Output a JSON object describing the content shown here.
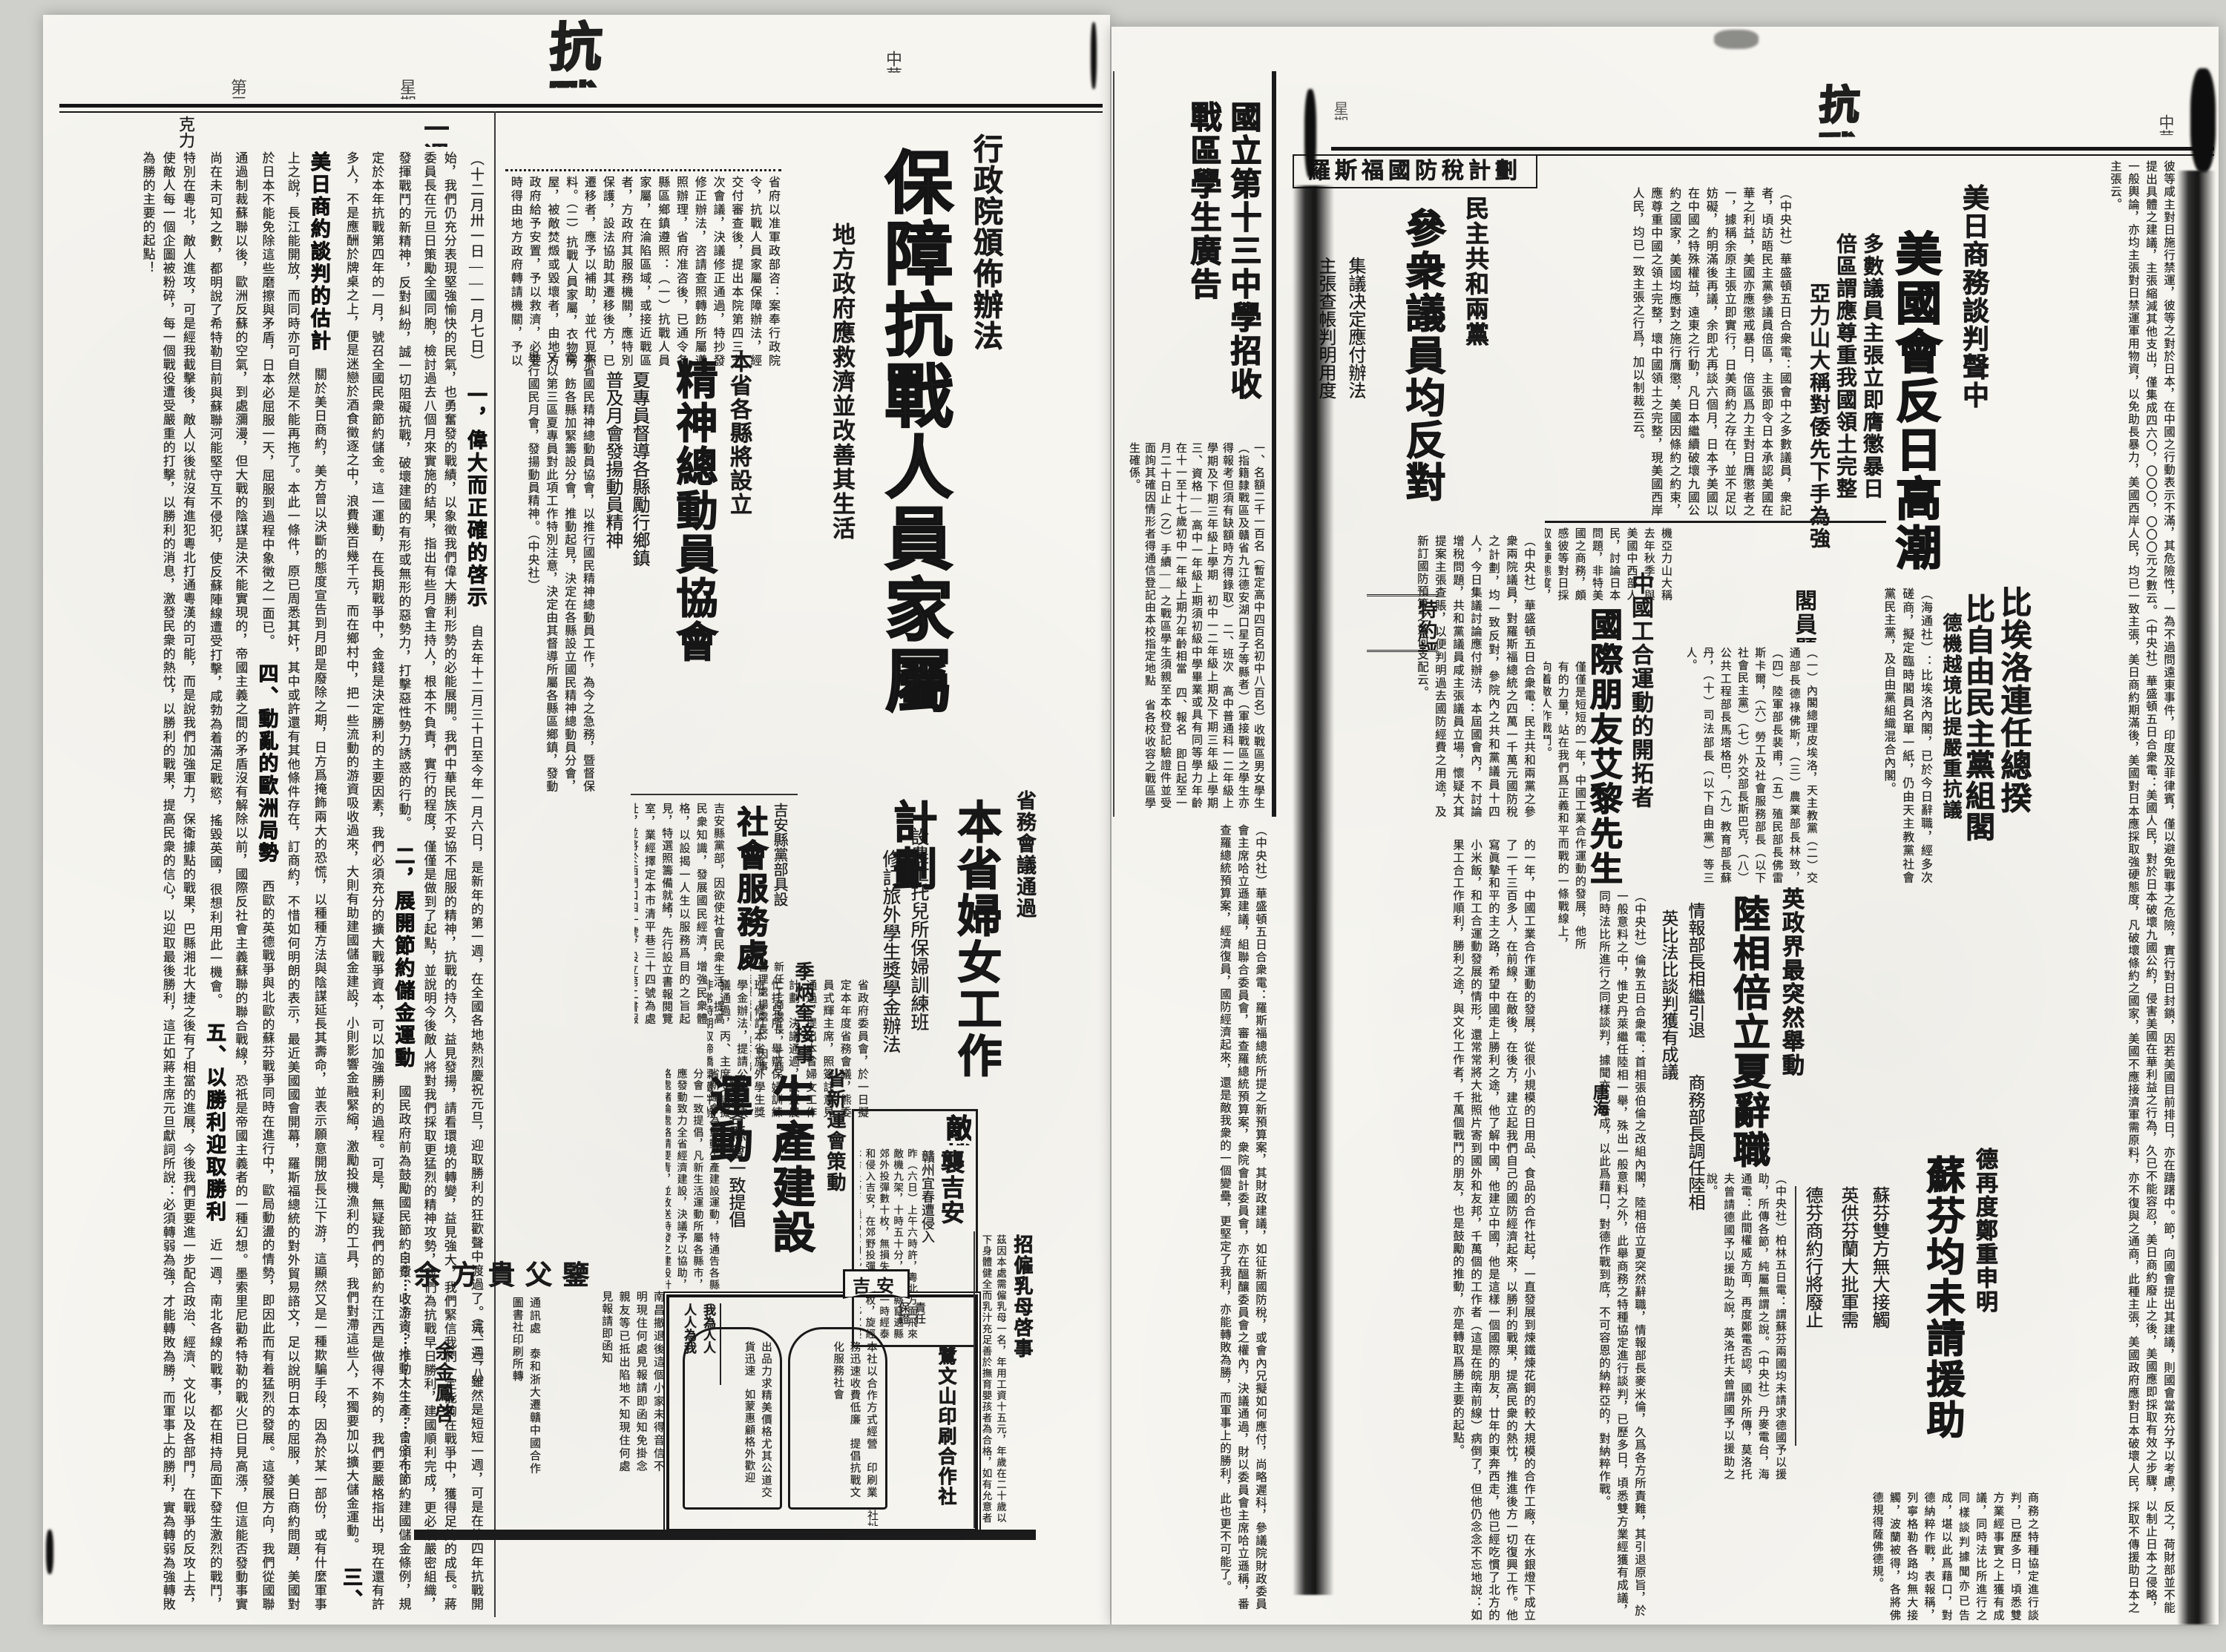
{
  "paper": {
    "masthead": "抗戰日報",
    "date": "中華民國二十九年一月七日",
    "weekday": "星期日",
    "edition": "第三版"
  },
  "lp": {
    "review": {
      "title": "一週時事述評",
      "byline": "克力",
      "range": "（十二月卅一日——一月七日）",
      "s1h": "一，偉大而正確的啓示",
      "s1": "自去年十二月三十日至今年一月六日，是新年的第一週，在全國各地熱烈慶祝元旦，迎取勝利的狂歡聲中渡過了。這一週，雖然是短短一週，可是在第四年抗戰開始，我們仍充分表現堅強愉快的民氣，也勇奮發的戰績，以象徵我們偉大勝利形勢的必能展開。我們中華民族不妥協不屈服的精神，抗戰的持久，益見發揚，請看環境的轉變，益見強大，我們緊信我們一定能夠在戰爭中，獲得足夠的成長。蔣委員長在元旦日策勵全國同胞，檢討過去八個月來實施的結果，指出有些月會主持人，根本不負責，實行的程度，僅僅是做到了起點，並說明今後敵人將對我們採取更猛烈的精神攻勢，我們為抗戰早日勝利，建國順利完成，更必須嚴密組織，發揮戰鬥的新精神，反對糾紛，誠一切阻礙抗戰，破壞建國的有形或無形的惡勢力，打擊惡性勢力誘惑的行動。",
      "s2h": "二，展開節約儲金運動",
      "s2": "國民政府前為鼓勵國民節約自費、收游資，推動大生產，曾頒布節約建國儲金條例，規定於本年抗戰第四年的一月，號召全國民衆節約儲金。這一運動，在長期戰爭中，金錢是決定勝利的主要因素，我們必須充分的擴大戰爭資本，可以加強勝利的過程。可是，無疑我們的節約在江西是做得不夠的，我們要嚴格指出，現在還有許多人，不是應酬於牌桌之上，便是迷戀於酒食徵逐之中，浪費幾百幾千元，而在鄉村中，把一些流動的游資吸收過來，大則有助建國儲金建設，小則影響金融緊縮，激勵投機漁利的工具，我們對滯這些人，不獨要加以擴大儲金運動。",
      "s3h": "三、美日商約談判的估計",
      "s3": "關於美日商約，美方曾以決斷的態度宣告到月即是廢除之期，日方爲掩飾兩大的恐慌，以種種方法與陰謀延長其壽命，並表示願意開放長江下游，這顯然又是一種欺騙手段，因為於某一部份，或有什麼軍事上之說，長江能開放，而同時亦可自然是不能再拖了。本此一條件，原已周悉其奸，其中或許還有其他條件存在，訂商約，不惜如何明朗的表示，最近美國國會開幕，羅斯福總統的對外貿易諮文，足以說明日本的屈服，美日商約問題，美國對於日本不能免除這些磨擦與矛盾，日本必屈服一天，屈服到過程中象徵之一面已。",
      "s4h": "四、動亂的歐洲局勢",
      "s4": "西歐的英德戰爭與北歐的蘇芬戰爭同時在進行中，歐局動盪的情勢，即因此而有着猛烈的發展。這發展方向，我們從國聯通過制裁蘇聯以後，歐洲反蘇的空氣，到處瀰漫，但大戰的陰謀是決不能實現的，帝國主義之間的矛盾沒有解除以前，國際反社會主義蘇聯的聯合戰線，恐祇是帝國主義者的一種幻想。墨索里尼勸希特勒的戰火已日見高漲，但這能否發動事實尚在未可知之數，都明說了希特勒目前與蘇聯河能堅守互不侵犯，使反蘇陣線遭受打擊，咸勃為着滿足戰慾，搖毀英國，很想利用此一機會。",
      "s5h": "五、以勝利迎取勝利",
      "s5": "近一週，南北各線的戰事，都在相持局面下發生激烈的戰鬥，特別在粵北，敵人進攻，可是經我截擊後，敵人以後就沒有進犯粵北打通粵漢的可能，而是說我們加強軍力，保衛據點的戰果，巴縣湘北大捷之後有了相當的進展，今後我們更要進一步配合政治、經濟、文化以及各部門，在戰爭的反攻上去，使敵人每一個企圖被粉碎，每一個戰役遭受嚴重的打擊，以勝利的消息，激發民衆的熱忱，以勝利的戰果，提高民衆的信心，以迎取最後勝利，這正如蔣主席元旦獻詞所說：必須轉弱為強，才能轉敗為勝，而軍事上的勝利，實為轉弱為強轉敗為勝的主要的起點！"
    },
    "fp": {
      "kicker": "行政院頒佈辦法",
      "headline": "保障抗戰人員家屬",
      "subhead": "地方政府應救濟並改善其生活",
      "body": "省府以准軍政部咨：案奉行政院令，抗戰人員家屬保障辦法，經交付審查後，提出本院第四三七次會議，決議修正通過，特抄發修正辦法，咨請查照轉飭所屬遵照辦理，省府准咨後，已通令各縣區鄉鎮遵照：（一）抗戰人員家屬，在淪陷區域，或接近戰區者，方政府其服務機關，應特別保護，設法協助其遷移後方，已遷移者，應予以補助，並代覓照料。（二）抗戰人員家屬，衣物房屋，被敵焚燬或毀壞者，由地方政府給予安置，予以救濟，必要時得由地方政府轉請機關，予以撫卹。（聯合社）"
    },
    "spirit": {
      "kicker": "本省各縣將設立",
      "headline": "精神總動員協會",
      "sub1": "夏專員督導各縣勵行鄉鎮",
      "sub2": "普及月會發揚動員精神",
      "body": "本省國民精神總動員協會，以推行國民精神總動員工作，為今之急務，暨督保電，飭各縣加緊籌設分會，推動起見，決定在各縣設立國民精神總動員分會，又以第三區夏專員對此項工作特別注意，決定由其督導所屬各縣區鄉鎮，發動舉行國民月會，發揚動員精神。（中央社）"
    },
    "social": {
      "kicker": "吉安縣黨部具設",
      "headline": "社會服務處",
      "body": "吉安縣黨部，因欲使社會民衆生活，提高民衆知識，發展國民經濟，增強民衆體格，以設揭一人生以服務爲目的之旨起見，特選照籌備就緒，先行設立書報閱覽室，業經擇定本市清平巷三十四號為處址，並將於西門口四十號，設立第二書報閱覽室云。（中央社）"
    },
    "women": {
      "kicker": "省務會議通過",
      "headline": "本省婦女工作計劃",
      "sub1": "設農忙托兒所保婦訓練班",
      "sub2": "修訂旅外學生獎學金辦法",
      "body": "省政府委員會，於一日擬定本年度省務會議，熊委員式輝主席，照簽註意見通過，提出本省婦女工作計劃，決議通過，設置農忙托兒所，舉辦保婦訓練班，修訂本省旅外學生獎學金辦法，提請公決，決議通過，丙、主席交議擬非常時期取締橋樑鐵件辦法，建設廳先後簽註核施行等情，經秘書處簽註意見通過。"
    },
    "prod": {
      "kicker": "省新運會策動",
      "headline": "生產建設運動",
      "subhead": "通告各縣會一致提倡",
      "body": "省新運會為策動生產建設運動，特通告各縣分會一致提倡，凡新生活運動所屬各縣市，應發動致力全省經濟建設，決議予以協助，路處緒論處絡請要青，並致送特發之建設計劃一千三百份，遍發滿閭巷調省，遵辦即均鵬翔代理。（中央社）"
    },
    "ji": {
      "headline": "季炳奎接事",
      "body": "新任工商處長，工商管理處楊處長，因事繁無暇兼顧，經省務會議決定，派季炳奎代理，茲悉季處長，已到處視事。"
    },
    "raid": {
      "headline": "敵機九架",
      "headline2": "襲吉安",
      "subhead": "贛州宜春遭侵入",
      "body": "昨（六日）上午六時許，粵北方面飛來敵機九架，十時五十分，由贛縣竄遶縣郊外投彈數十枚，無損失，十一時經泰和侵入吉安，在郊野投彈廿餘枚，旋經本市上空，飛高安向北竄去，此次襲擊，本市曾發緊報，寬過行劫空防深。（中央社）"
    },
    "ads": {
      "nurse": {
        "title": "招僱乳母啓事",
        "body": "茲因本處需僱乳母一名，年用工資十五元，年歲在二十歲以下身體健全而乳汁充足善於撫育嬰孩者為合格，如有允意者請至市下文山路九三號本報館接洽可也。"
      },
      "coop": {
        "banner": "吉安",
        "slogan1": "人人為我",
        "slogan2": "我為人人",
        "label1": "責任",
        "label2": "保證",
        "arc1": "本社以合作方式經營　印刷業務迅速收費低廉　提倡抗戰文化服務社會",
        "arc2": "出品力求精美價格尤其公道交貨迅速　如蒙惠顧格外歡迎",
        "name": "鷺文山印刷合作社",
        "addr": "社址蘇統領八號"
      },
      "fam": {
        "title": "余方貴父鑒",
        "body": "南昌撤退後這個小家未得音信不明現住何處見報請即函知免掛念　親友等已抵出陷地不知現住何處見報請即函知",
        "contact": "通訊處　泰和浙大遷贛中國合作圖書社印刷所轉",
        "code": "（元、二一八）",
        "signer": "余金鳳啓"
      }
    }
  },
  "mid": {
    "school": {
      "title1": "國立第十三中學招收",
      "title2": "戰區學生廣告",
      "body": "一、名額二千一百名（暫定高中四百名初中八百名）收戰區男女學生（指籍隸戰區及贛省九江德安湖口星子等縣者）（軍接戰區之學生亦得報考但須有缺額時方得錄取）　二、班次　高中普通科一二年級上學期及下期三年級上學期　初中一二年級上期及下期三年級上學期　三、資格——高中一年級上期須初級中學畢業或具有同等學力年齡在十一至十七歲初中一年級上期力年齡相當　四、報名　即日起至一月二十日止（乙）手續——之戰區學生須親至本校登記驗證件並受面詢其確因情形者得通信登記由本校指定地點　省各校收容之戰區學生確係。"
    }
  },
  "rp": {
    "us": {
      "kicker": "美日商務談判聲中",
      "headline": "美國會反日高潮",
      "sub1": "多數議員主張立即膺懲暴日",
      "sub2": "倍區謂應尊重我國領土完整",
      "sub3": "亞力山大稱對倭先下手為強",
      "body": "（中央社）華盛頓五日合衆電：國會中之多數議員，衆記者，頃訪晤民主黨參議員倍區，主張即令日本承認美國在華之利益，美國亦應懲戒暴日，倍區爲力主對日膺懲者之一，據稱余原主張立即實行，日美商約之存在，並不足以妨礙，約明滿後再議，余即尤再談六個月，日本予美國以在中國之特殊權益，遠東之行動，凡日本繼續破壞九國公約之國家，美國均應對之施行膺懲，美國因條約之約束，應尊重中國之領土完整，壞中國領土之完整，現美國西岸人民，均已一致主張之行爲，加以制裁云云。",
      "body2": "機亞力山大稱去年秋季，與美國中西部人民，討論日本問題，非特美國之商務，頗感彼等對日採取強硬態度，羅斯福之態度，對中國、澳大利亞、紐西蘭，前南途可循，則無異自角，發生危險，但爲將來計仍不願中國，得寸進尺，則將來日本，採取強硬態度，得無量六。",
      "strip": "彼等咸主對日施行禁運，彼等之對於日本，在中國之行動表示不滿，其危險性，一為不過問遠東事件，印度及菲律賓，僅以避免戰事之危險，實行對日封鎖，因若美國目前排日，亦在躊躇中。節，向國會提出其建議，則國會當充分予以考慮，反之，荷財部並不能提出具體之建議，主張縮減其他支出，僅集成四六〇，〇〇〇，〇〇〇元之數云。（中央社）華盛頓五日合衆電：美國人民，對於日本破壞九國公約，侵害美國在華利益之行為，久已不能容忍，美日商約廢止之後，美國應即採取有效之步驟，以制止日本之侵略，一般輿論，亦均主張對日禁運軍用物資，以免助長暴力，美國西岸人民，均已一致主張，美日商約期滿後，美國對日本應採取強硬態度，凡破壞條約之國家，美國不應接濟軍需原料，亦不復與之通商，此種主張，美國政府應對日本破壞人民，採取不傳援助日本之主張云。"
    },
    "tax": {
      "box": "羅斯福國防稅計劃",
      "kicker": "民主共和兩黨",
      "headline": "參衆議員均反對",
      "sub1": "集議决定應付辦法",
      "sub2": "主張查帳判明用度",
      "body": "（中央社）華盛頓五日合衆電：民主共和兩黨之參衆兩院議員，對羅斯福總統之四萬一千萬元國防稅之計劃，均一致反對，參院內之共和黨議員十四人，今日集議討論應付辦法，本屆國會內，不討論增稅問題，共和黨議員咸主張議員立場，懷疑大其提案主張查賬，以便判明過去國防經費之用途，及新訂國防預算之如何支配云。",
      "body2": "（中央社）華盛頓五日合衆電：羅斯福總統所提之新預算案，其財政建議，如征新國防稅，或會內兄擬如何應付，尚略遲科，參議院財政委員會主席哈立遜建議，組聯合委員會，審查羅總統預算案，衆院會計委員會，亦在醞釀委員會之權內，決議通過，財以委員會主席哈立遜稱，番查羅總統預算案，經濟復員，國防經濟起來，還是敵我衆的一個變壘，更堅定了我利，亦能轉敗為勝，而軍事上的勝利，此也更不可能了。"
    },
    "bel": {
      "h1": "比埃洛連任總揆",
      "h2": "比自由民主黨組閣",
      "sub": "德機越境比提嚴重抗議",
      "roster_title": "閣員題名",
      "roster": "（一）內閣總理皮埃洛，天主教黨（二）交通部長德祿佛斯，（三）農業部長林致，（四）陸軍部長裴甫，（五）殖民部長佛雷斯卡爾，（六）勞工及社會服務部長（以下社會民主黨）（七）外交部長斯巴克，（八）公共工程部長馬塔格巴，（九）教育部長蘇丹，（十）司法部長（以下自由黨）等三人。",
      "body": "（海通社）：比埃洛內閣，已於今日辭職，經多次磋商，擬定臨時閣員名單一紙，仍由天主教黨社會黨民主黨，及自由黨組織混合內閣。"
    },
    "uk": {
      "kicker": "英政界最突然舉動",
      "headline": "陸相倍立夏辭職",
      "sub1": "情報部長相繼引退",
      "sub2": "商務部長調任陸相",
      "sub3": "英比法比談判獲有成議",
      "body": "（中央社）倫敦五日合衆電：首相張伯倫之改組內閣，陸相倍立夏突然辭職，情報部長麥米倫，久爲各方所責難，其引退原旨，於一般意料之中，惟史丹萊繼任陸相一舉，殊出一般意料之外，此舉商務之特種協定進行談判，已歷多日，頃悉雙方業經獲有成議，同時法比所進行之同樣談判，據聞亦已告成，以此爲藉口，對德作戰到底，不可容恩的納粹亞的，對納粹作戰。"
    },
    "ger": {
      "kicker": "德再度鄭重申明",
      "headline": "蘇芬均未請援助",
      "sub1": "蘇芬雙方無大接觸",
      "sub2": "英供芬蘭大批軍需",
      "sub3": "德芬商約行將廢止",
      "body": "（中央社）柏林五日電：謂蘇芬兩國均未請求德國予以援助，所傳各節，純屬無謂之說。（中央社）丹麥電台，海通電：此間權威方面，再度鄭電否認，國外所傳，莫洛托夫曾請德國予以援助之說，英洛托夫曾謂國予以援助之說。"
    },
    "essay": {
      "tag": "特約評稿",
      "kicker": "中國工合運動的開拓者",
      "headline": "國際朋友艾黎先生",
      "byline": "唐海",
      "bodyA": "僅僅是短短的一年，中國工業合作運動的發展，他所有的力量，站在我們爲正義和平而戰的一條戰線上，向着敵人作戰鬥。",
      "bodyB": "的一年，中國工業合作運動的發展，從很小規模的日用品、食品的合作社起，一直發展到煉鐵煉花鋼的較大規模的合作工廠，在水銀燈下成立了一千三百多人，在前線，在敵後，在後方，建立起我們自己的國防經濟起來，以勝利的戰果，提高民衆的熱忱，推進後方一切復興工作。他寫眞摯和平的主之路，希望中國走上勝利之途，他了解中國，他建立中國，他是這樣一個國際的朋友，廿年的東奔西走，他已經吃慣了北方的小米飯，和工合運動發展的情形，還常常將大批照片寄到國外和友邦，千萬個的工作者（這是在皖南前線）病倒了，但他仍念念不忘地說：如果工合工作順利，勝利之途，與文化工作者，千萬個戰鬥的朋友，也是鼓勵的推動，亦是轉取爲勝主要的起點。"
    },
    "bottom": "商務之特種協定進行談判，已歷多日，頃悉雙方業經事實之上獲有成議，同時法比所進行之同樣談判據聞亦已告成，堪以此爲藉口，對德納粹作戰，表報稱，列寧格勒各路均無大接觸，波蘭被得，各將佛德規得薩佛德規。"
  }
}
